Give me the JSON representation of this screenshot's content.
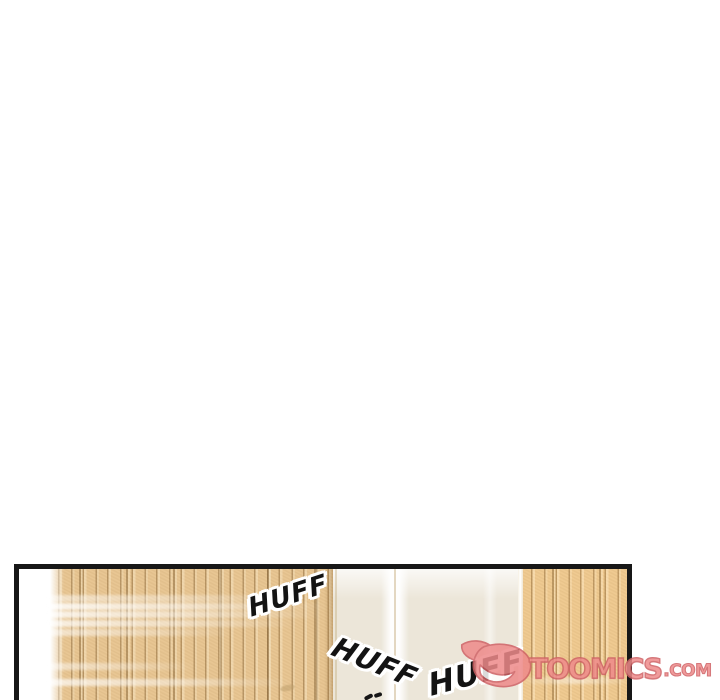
{
  "page": {
    "background": "#ffffff",
    "description": "webtoon comic strip segment, mostly blank gutter above a cropped panel"
  },
  "panel": {
    "colors": {
      "border": "#171717",
      "wood": "#e7c48f",
      "wood_line": "#8a6434",
      "cream": "#ece6d9",
      "white_strip": "#ffffff"
    },
    "sfx": [
      {
        "text": "HUFF"
      },
      {
        "text": "HUFF"
      },
      {
        "text": "HUFF"
      }
    ]
  },
  "watermark": {
    "brand": "TOOMICS",
    "suffix": ".COM",
    "color": "#ee8a8a",
    "outline": "#cf6165",
    "icon": "toomics-devil-d-logo"
  }
}
